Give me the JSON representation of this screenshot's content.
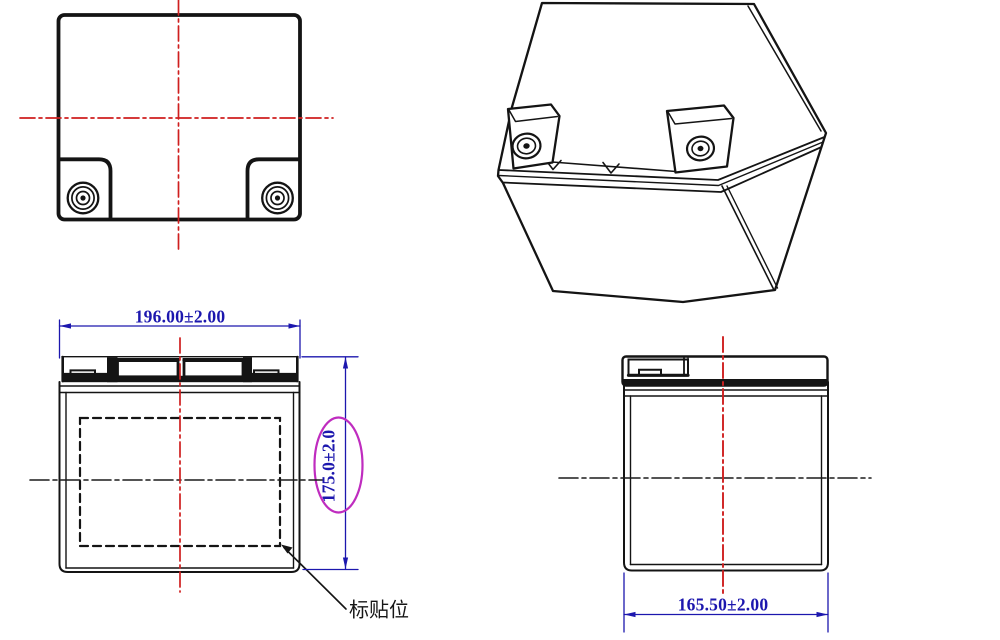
{
  "drawing": {
    "front_view": {
      "width_dimension": "196.00±2.00",
      "height_dimension": "175.0±2.0",
      "label_annotation": "标贴位"
    },
    "side_view": {
      "depth_dimension": "165.50±2.00"
    }
  },
  "colors": {
    "line_black": "#141414",
    "centerline_red": "#cf1f1f",
    "dimension_blue": "#1c17ae",
    "highlight_magenta": "#bf2cbf"
  }
}
